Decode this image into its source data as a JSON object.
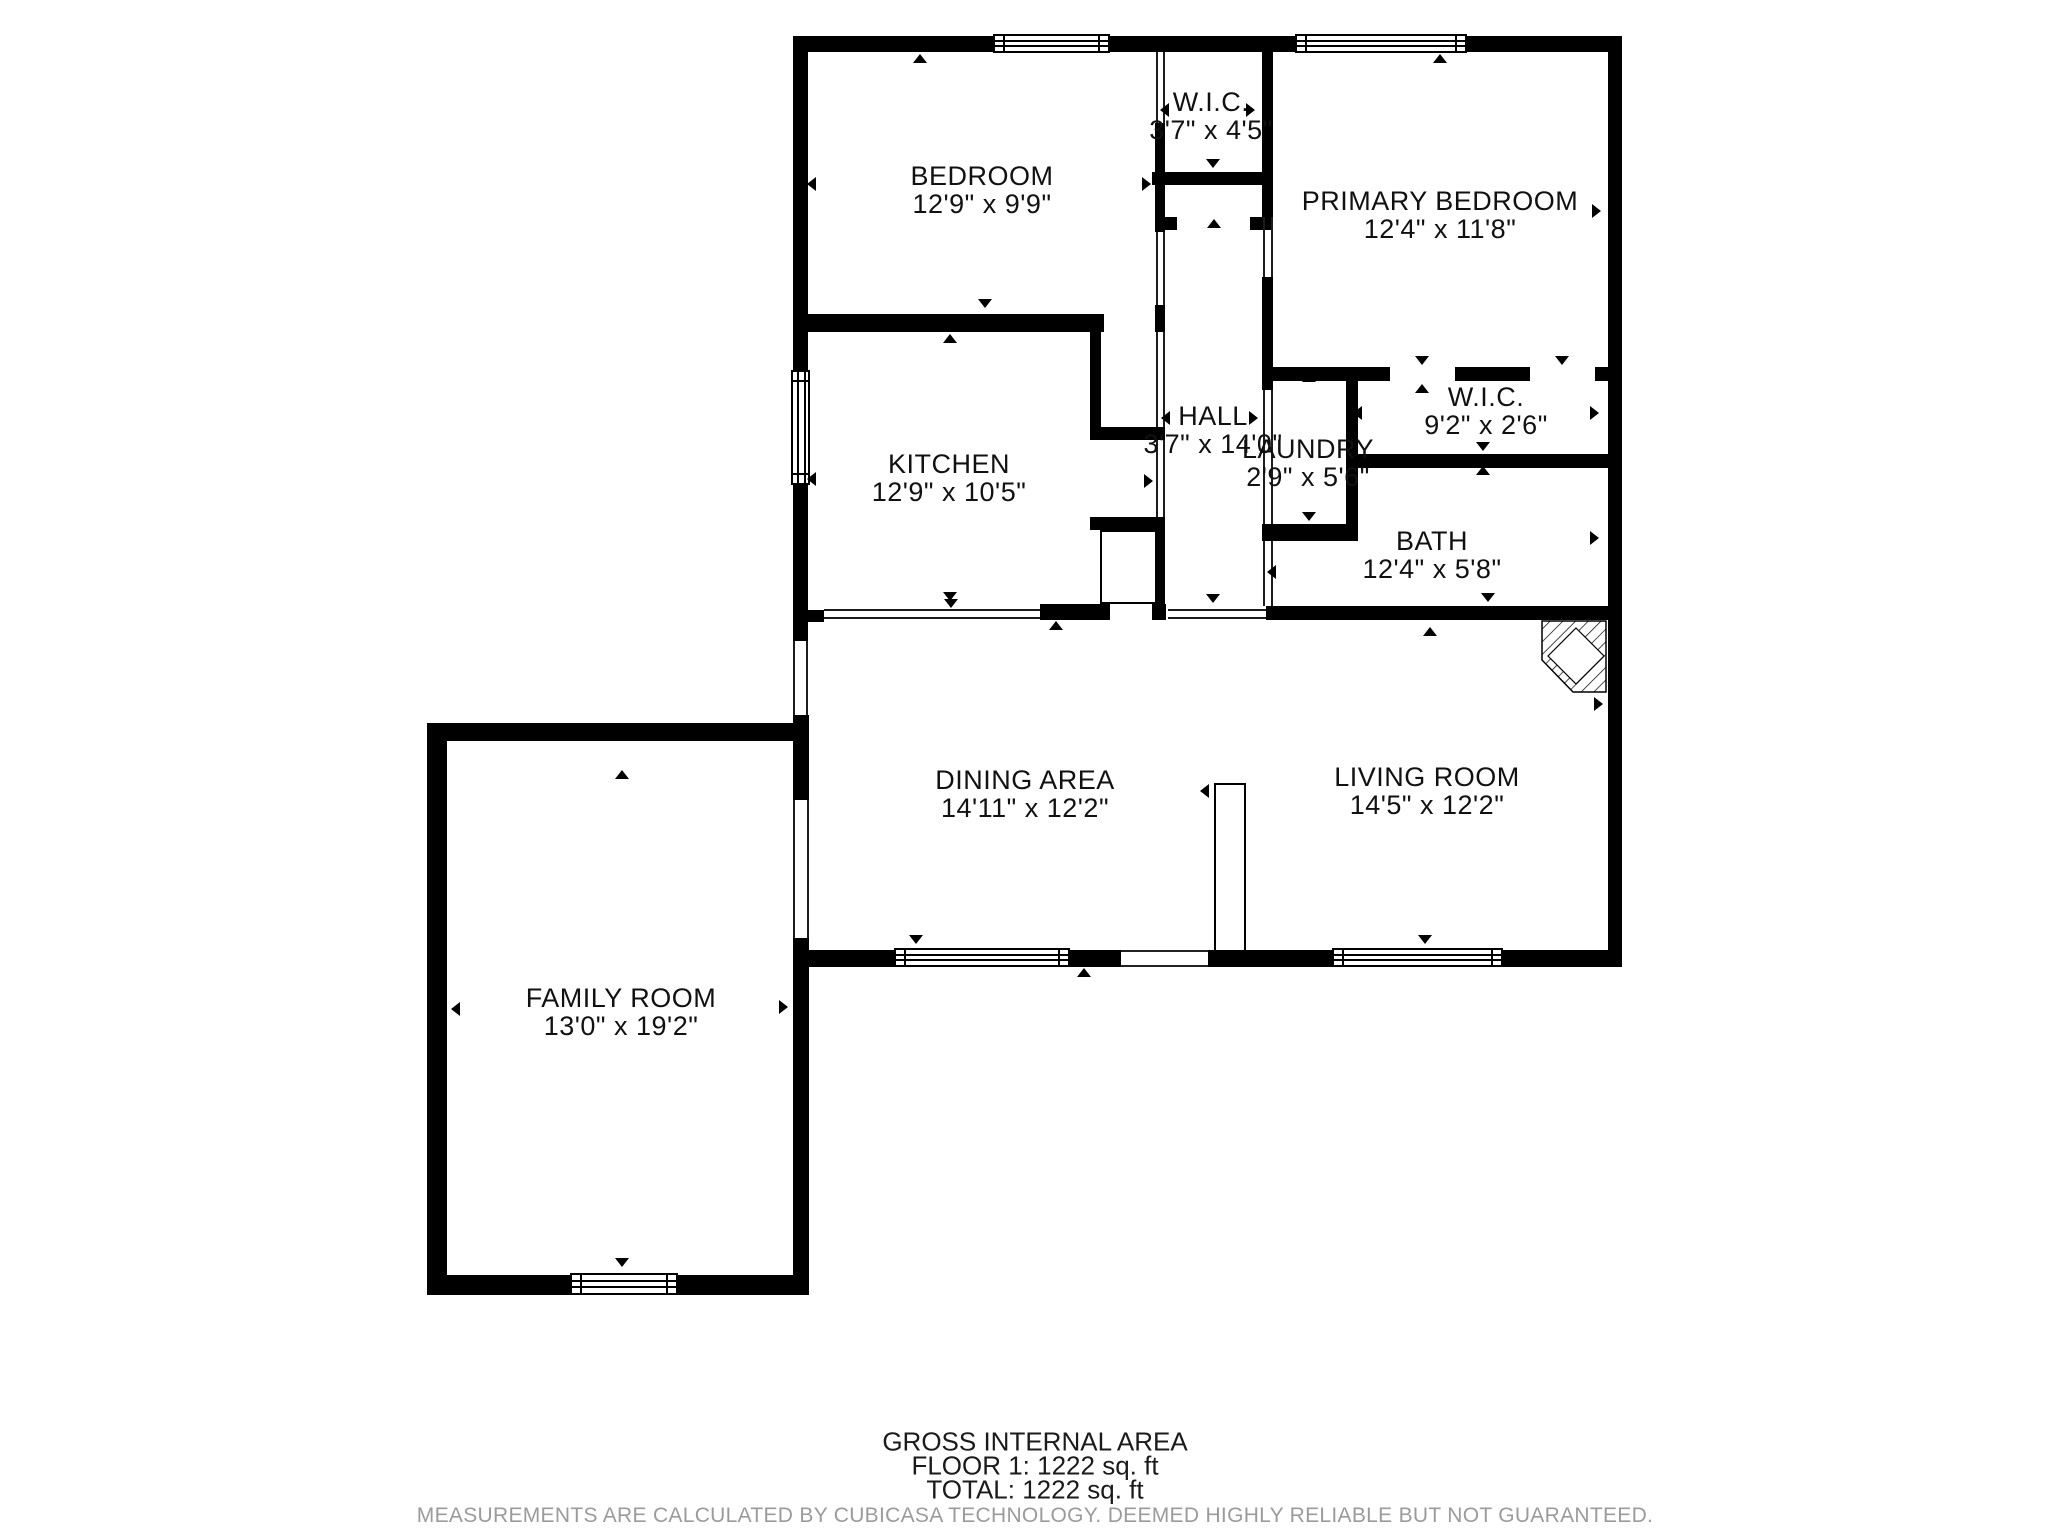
{
  "floor_plan": {
    "rooms": [
      {
        "id": "bedroom",
        "name": "BEDROOM",
        "dims": "12'9\" x 9'9\""
      },
      {
        "id": "wic1",
        "name": "W.I.C.",
        "dims": "3'7\" x 4'5\""
      },
      {
        "id": "primary-bedroom",
        "name": "PRIMARY BEDROOM",
        "dims": "12'4\" x 11'8\""
      },
      {
        "id": "kitchen",
        "name": "KITCHEN",
        "dims": "12'9\" x 10'5\""
      },
      {
        "id": "hall",
        "name": "HALL",
        "dims": "3'7\" x 14'0\""
      },
      {
        "id": "laundry",
        "name": "LAUNDRY",
        "dims": "2'9\" x 5'6\""
      },
      {
        "id": "wic2",
        "name": "W.I.C.",
        "dims": "9'2\" x 2'6\""
      },
      {
        "id": "bath",
        "name": "BATH",
        "dims": "12'4\" x 5'8\""
      },
      {
        "id": "dining-area",
        "name": "DINING AREA",
        "dims": "14'11\" x 12'2\""
      },
      {
        "id": "living-room",
        "name": "LIVING ROOM",
        "dims": "14'5\" x 12'2\""
      },
      {
        "id": "family-room",
        "name": "FAMILY ROOM",
        "dims": "13'0\" x 19'2\""
      }
    ],
    "footer": {
      "title": "GROSS INTERNAL AREA",
      "floor_line": "FLOOR 1: 1222 sq. ft",
      "total_line": "TOTAL: 1222 sq. ft",
      "disclaimer": "MEASUREMENTS ARE CALCULATED BY CUBICASA TECHNOLOGY. DEEMED HIGHLY RELIABLE BUT NOT GUARANTEED."
    },
    "colors": {
      "wall": "#000000",
      "text": "#111111",
      "disclaimer": "#9b9b9b",
      "background": "#ffffff"
    }
  }
}
